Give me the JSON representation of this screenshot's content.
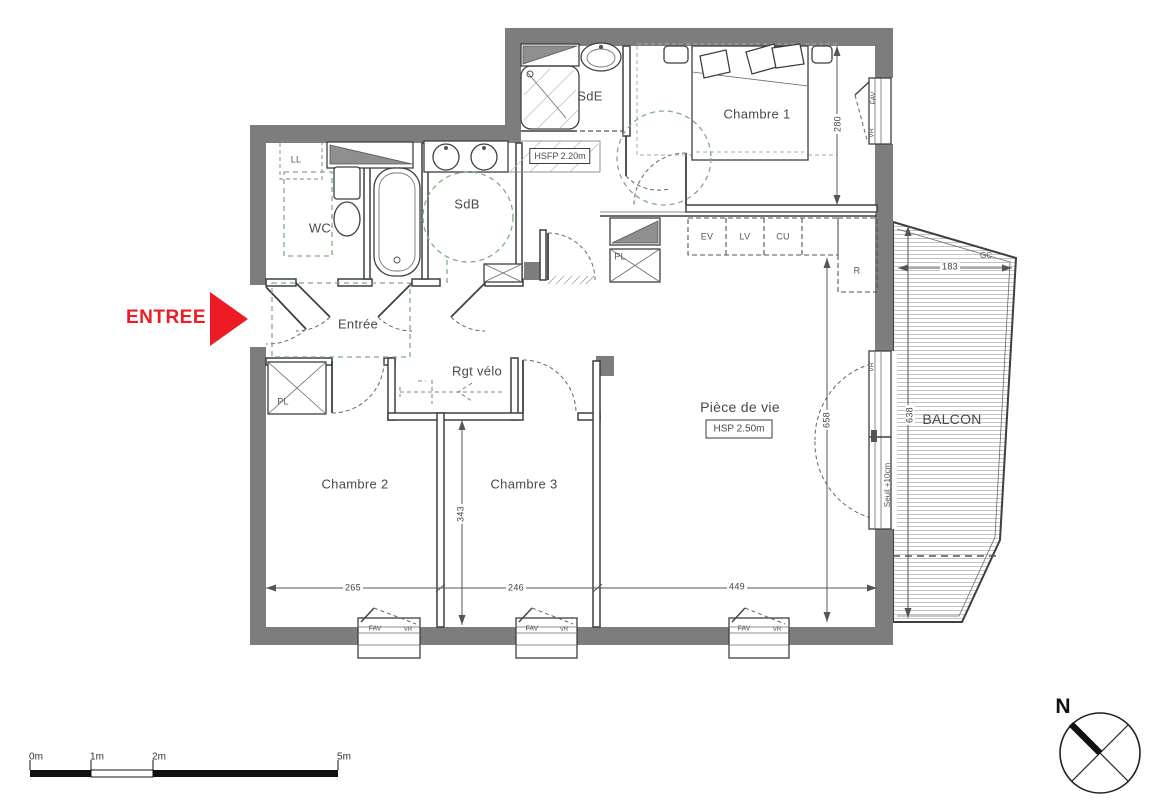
{
  "plan": {
    "rooms": {
      "sde": "SdE",
      "chambre1": "Chambre 1",
      "wc": "WC",
      "sdb": "SdB",
      "entree": "Entrée",
      "rgt_velo": "Rgt vélo",
      "chambre2": "Chambre 2",
      "chambre3": "Chambre 3",
      "piece_de_vie": "Pièce de vie",
      "balcon": "BALCON"
    },
    "entry_marker": "ENTREE",
    "height_notes": {
      "hsfp": "HSFP 2.20m",
      "hsp": "HSP 2.50m"
    },
    "equipment": {
      "ll": "LL",
      "pl": "PL",
      "ev": "EV",
      "lv": "LV",
      "cu": "CU",
      "r": "R",
      "gc": "GC",
      "fav": "FAV",
      "vr": "VR",
      "seuil": "Seuil +10cm"
    },
    "dimensions": {
      "chambre2_width": "265",
      "chambre3_width": "246",
      "piece_de_vie_width": "449",
      "chambre3_depth": "343",
      "chambre1_depth": "280",
      "balcon_width": "183",
      "piece_de_vie_depth": "658",
      "balcon_depth": "638"
    },
    "scale_bar": {
      "m0": "0m",
      "m1": "1m",
      "m2": "2m",
      "m5": "5m"
    },
    "compass_north": "N",
    "colors": {
      "wall_gray": "#7d7d7d",
      "entry_red": "#ed1c24",
      "accessibility_green": "#7fae7f",
      "line_dark": "#3f3f3f"
    }
  }
}
